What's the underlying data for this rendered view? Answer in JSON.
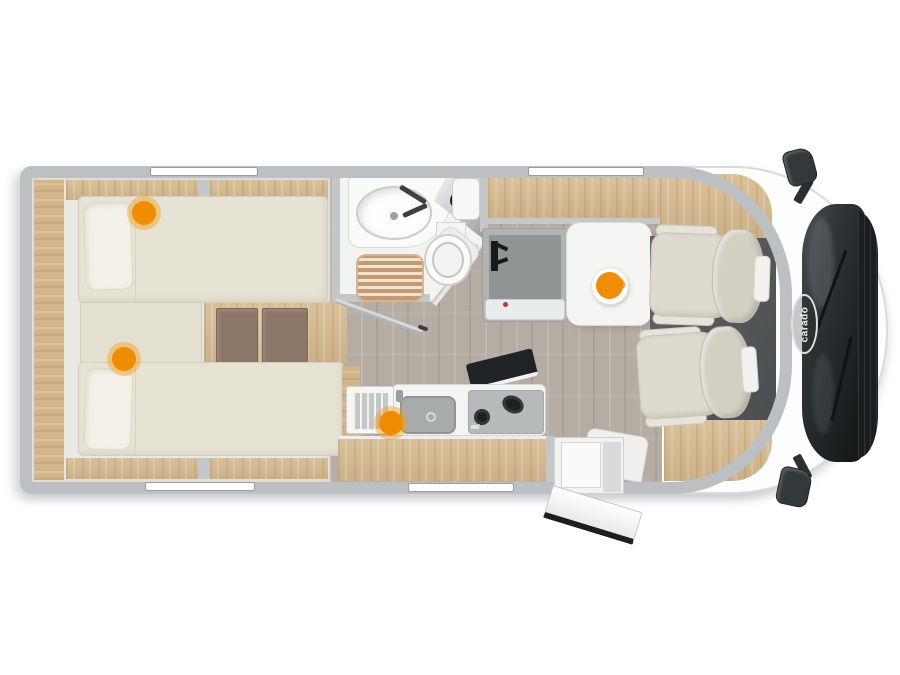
{
  "brand": {
    "logo_text": "carado"
  },
  "hotspots": [
    {
      "id": "bed-upper",
      "label": "Rear twin bed (upper) hotspot"
    },
    {
      "id": "bed-lower",
      "label": "Rear twin bed (lower) hotspot"
    },
    {
      "id": "kitchen",
      "label": "Kitchen hotspot"
    },
    {
      "id": "dinette",
      "label": "Dinette table hotspot"
    }
  ],
  "colors": {
    "accent_orange": "#f08c00",
    "wall_gray": "#bcc0c2",
    "wood_light": "#d6ba8e",
    "wood_step_dark": "#8c7668",
    "floor_taupe": "#b5aca3",
    "mattress_beige": "#e7e3d4",
    "seat_beige": "#dedacf",
    "windshield_dark": "#24282a",
    "cab_floor_dark": "#56595b"
  }
}
